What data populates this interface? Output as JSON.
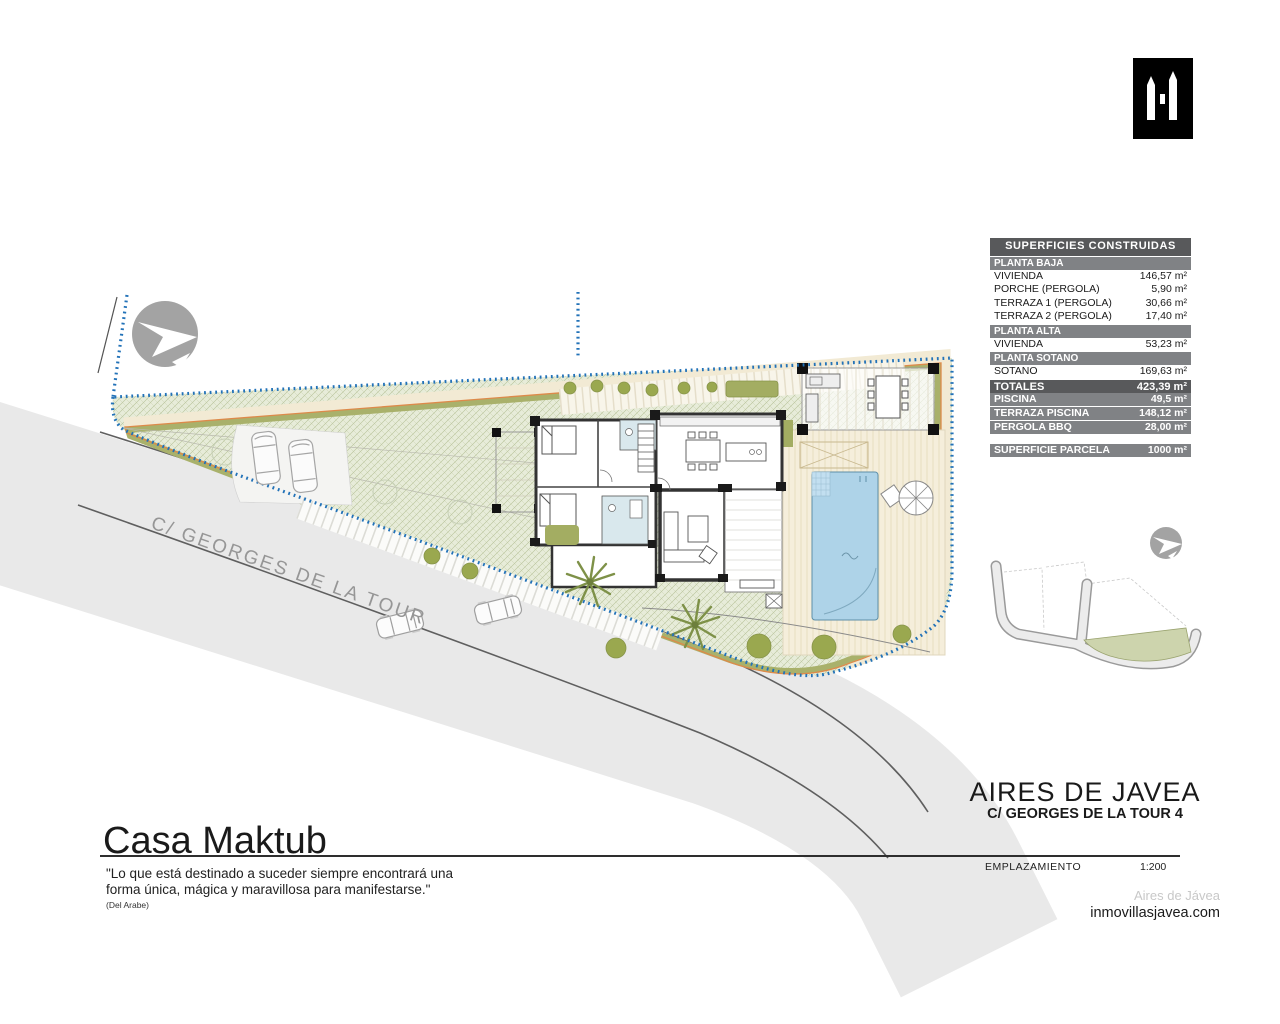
{
  "logo": {
    "name": "inmo-villas-logo"
  },
  "tables": {
    "superficies": {
      "title": "SUPERFICIES CONSTRUIDAS",
      "sections": [
        {
          "header": "PLANTA BAJA",
          "rows": [
            {
              "label": "VIVIENDA",
              "value": "146,57 m²"
            },
            {
              "label": "PORCHE (PERGOLA)",
              "value": "5,90 m²"
            },
            {
              "label": "TERRAZA 1 (PERGOLA)",
              "value": "30,66 m²"
            },
            {
              "label": "TERRAZA 2 (PERGOLA)",
              "value": "17,40 m²"
            }
          ]
        },
        {
          "header": "PLANTA ALTA",
          "rows": [
            {
              "label": "VIVIENDA",
              "value": "53,23 m²"
            }
          ]
        },
        {
          "header": "PLANTA SOTANO",
          "rows": [
            {
              "label": "SOTANO",
              "value": "169,63 m²"
            }
          ]
        }
      ],
      "total": {
        "label": "TOTALES",
        "value": "423,39 m²"
      }
    },
    "exterior": {
      "rows": [
        {
          "label": "PISCINA",
          "value": "49,5 m²"
        },
        {
          "label": "TERRAZA PISCINA",
          "value": "148,12 m²"
        },
        {
          "label": "PERGOLA BBQ",
          "value": "28,00 m²"
        }
      ]
    },
    "parcela": {
      "label": "SUPERFICIE PARCELA",
      "value": "1000 m²"
    }
  },
  "plan": {
    "street_label": "C/ GEORGES DE LA TOUR"
  },
  "title_block": {
    "project_title": "Casa Maktub",
    "quote": "\"Lo que está destinado a suceder siempre encontrará una forma única, mágica y maravillosa para manifestarse.\"",
    "quote_source": "(Del Arabe)",
    "location_title": "AIRES DE JAVEA",
    "location_subtitle": "C/ GEORGES DE LA TOUR 4",
    "sheet_label": "EMPLAZAMIENTO",
    "scale": "1:200",
    "watermark": "Aires de Jávea",
    "website": "inmovillasjavea.com"
  },
  "colors": {
    "boundary_blue": "#2272b8",
    "perimeter_orange": "#dd8a4a",
    "hedge_olive": "#a9b16b",
    "garden_green": "#e7ecd9",
    "pool_blue": "#aed3e8",
    "terrace_cream": "#f5eedb",
    "road_gray": "#e9e9e9",
    "table_header_gray": "#58595b",
    "table_section_gray": "#808285"
  }
}
